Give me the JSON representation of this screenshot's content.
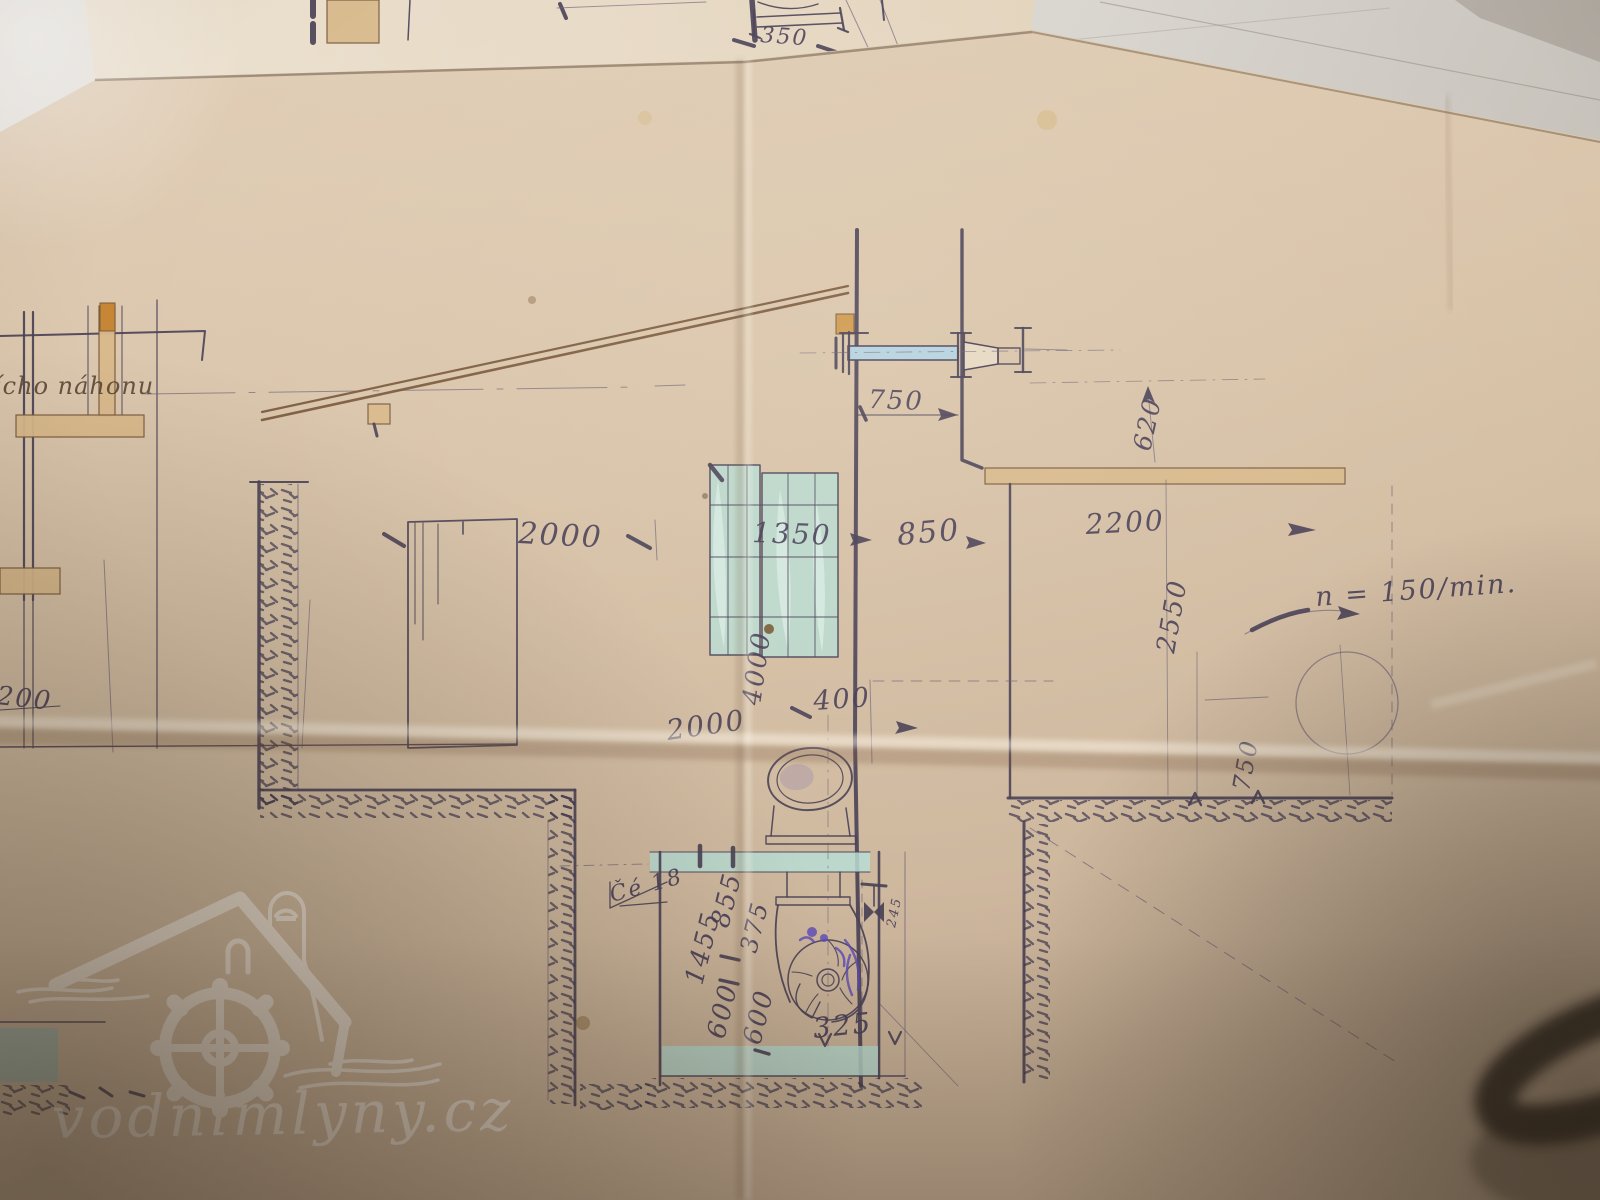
{
  "photo": {
    "watermark": "vodnimlyny.cz"
  },
  "annotations": {
    "headrace_note": "ícho náhonu",
    "speed_note": "n = 150/min.",
    "flag_label": "Čé 18"
  },
  "dimensions": {
    "top_fragment": "350",
    "shaft_offset": "750",
    "beam_drop": "620",
    "bay_left": "2000",
    "rack_width": "1350",
    "wall_gap": "850",
    "room_right": "2200",
    "rack_height": "4000",
    "channel_depth": "2000",
    "pipe_offset": "400",
    "room_height": "2550",
    "flywheel_drop": "750",
    "left_edge": "200",
    "pit_total": "1455",
    "pit_upper": "855",
    "pit_mid": "375",
    "pit_lower_a": "600",
    "pit_lower_b": "600",
    "outlet_width": "325",
    "valve_size": "245"
  },
  "colors": {
    "paper": "#d8c3a8",
    "ink": "#4a4156",
    "sepia": "#7a5a3c",
    "teal_wash": "#b9dcd2",
    "blue_wash": "#b5d2e0",
    "violet_ink": "#5b48b8",
    "watermark_white": "#ffffff"
  }
}
